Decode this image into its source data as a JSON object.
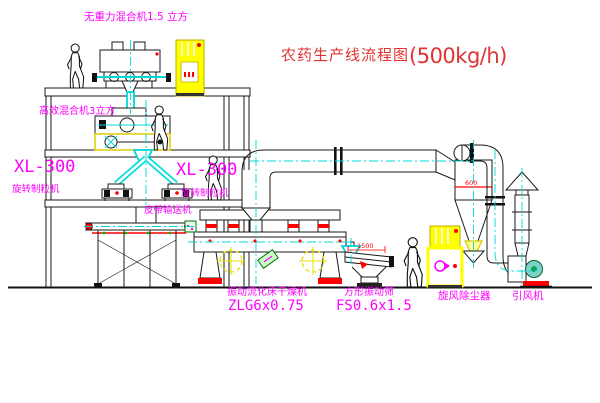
{
  "title": {
    "name": "农药生产线流程图",
    "capacity": "(500kg/h)"
  },
  "equipment_labels": {
    "gravity_mixer": "无重力混合机1.5 立方",
    "high_efficiency_mixer": "高效混合机3立方",
    "granulator_left_model": "XL-300",
    "granulator_left_name": "旋转制粒机",
    "granulator_right_model": "XL-300",
    "granulator_right_name": "旋转制粒机",
    "belt_conveyor": "皮带输送机",
    "dryer_name": "振动流化床干燥机",
    "dryer_model": "ZLG6x0.75",
    "sieve_name": "方形振动筛",
    "sieve_model": "FS0.6x1.5",
    "cyclone": "旋风除尘器",
    "fan": "引风机"
  },
  "dimensions": {
    "sieve_length": "1500",
    "cyclone_diameter": "600"
  },
  "colors": {
    "label_magenta": "#ff00ff",
    "title_red": "#e23333",
    "dimension_red": "#ff0000",
    "centerline_cyan": "#00d8d8",
    "cabinet_yellow": "#ffff00"
  }
}
